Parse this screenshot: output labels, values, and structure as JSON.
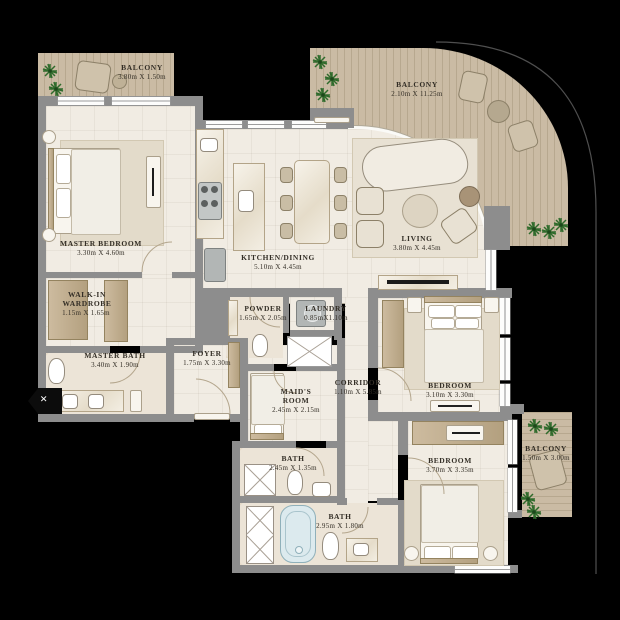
{
  "plan": {
    "title": "Apartment floor plan",
    "rooms": {
      "balcony_tl": {
        "name": "BALCONY",
        "dims": "3.80m X 1.50m"
      },
      "balcony_tr": {
        "name": "BALCONY",
        "dims": "2.10m X 11.25m"
      },
      "balcony_br": {
        "name": "BALCONY",
        "dims": "1.50m X 3.00m"
      },
      "master_bedroom": {
        "name": "MASTER BEDROOM",
        "dims": "3.30m X 4.60m"
      },
      "walk_in_wardrobe": {
        "name_line1": "WALK-IN",
        "name_line2": "WARDROBE",
        "dims": "1.15m X 1.65m"
      },
      "master_bath": {
        "name": "MASTER BATH",
        "dims": "3.40m X 1.90m"
      },
      "kitchen_dining": {
        "name": "KITCHEN/DINING",
        "dims": "5.10m X 4.45m"
      },
      "living": {
        "name": "LIVING",
        "dims": "3.80m X 4.45m"
      },
      "powder": {
        "name": "POWDER",
        "dims": "1.65m X 2.05m"
      },
      "laundry": {
        "name": "LAUNDRY",
        "dims": "0.85mX1.10m"
      },
      "foyer": {
        "name": "FOYER",
        "dims": "1.75m X 3.30m"
      },
      "corridor": {
        "name": "CORRIDOR",
        "dims": "1.10m X 5.85m"
      },
      "maids_room": {
        "name_line1": "MAID'S",
        "name_line2": "ROOM",
        "dims": "2.45m X 2.15m"
      },
      "bath_upper": {
        "name": "BATH",
        "dims": "2.45m X 1.35m"
      },
      "bath_lower": {
        "name": "BATH",
        "dims": "2.95m X 1.80m"
      },
      "bedroom_mid": {
        "name": "BEDROOM",
        "dims": "3.10m X 3.30m"
      },
      "bedroom_bottom": {
        "name": "BEDROOM",
        "dims": "3.70m X 3.35m"
      }
    },
    "colors": {
      "wall": "#8d8d8d",
      "floor": "#f1ece3",
      "deck_wood": "#c4b59e",
      "plant_green": "#2f6b2c",
      "text": "#34302a",
      "background": "#000000"
    },
    "marker": {
      "entry_cut_symbol": "×"
    }
  }
}
